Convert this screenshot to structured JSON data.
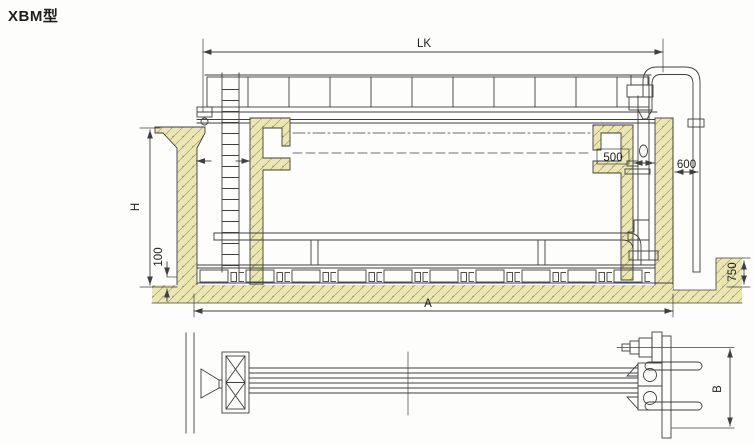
{
  "title": "XBM型",
  "drawing": {
    "dims": {
      "lk": "LK",
      "h": "H",
      "floor_slab": "100",
      "overall_a": "A",
      "trough_500": "500",
      "wall_gap_600": "600",
      "channel_depth_750": "750",
      "plan_b": "B"
    }
  },
  "colors": {
    "line": "#3f3f3f",
    "concrete_fill": "#ebe6b2",
    "hatch_line": "#a39d74",
    "text": "#1e1e1e",
    "background": "#fdfdfc"
  }
}
